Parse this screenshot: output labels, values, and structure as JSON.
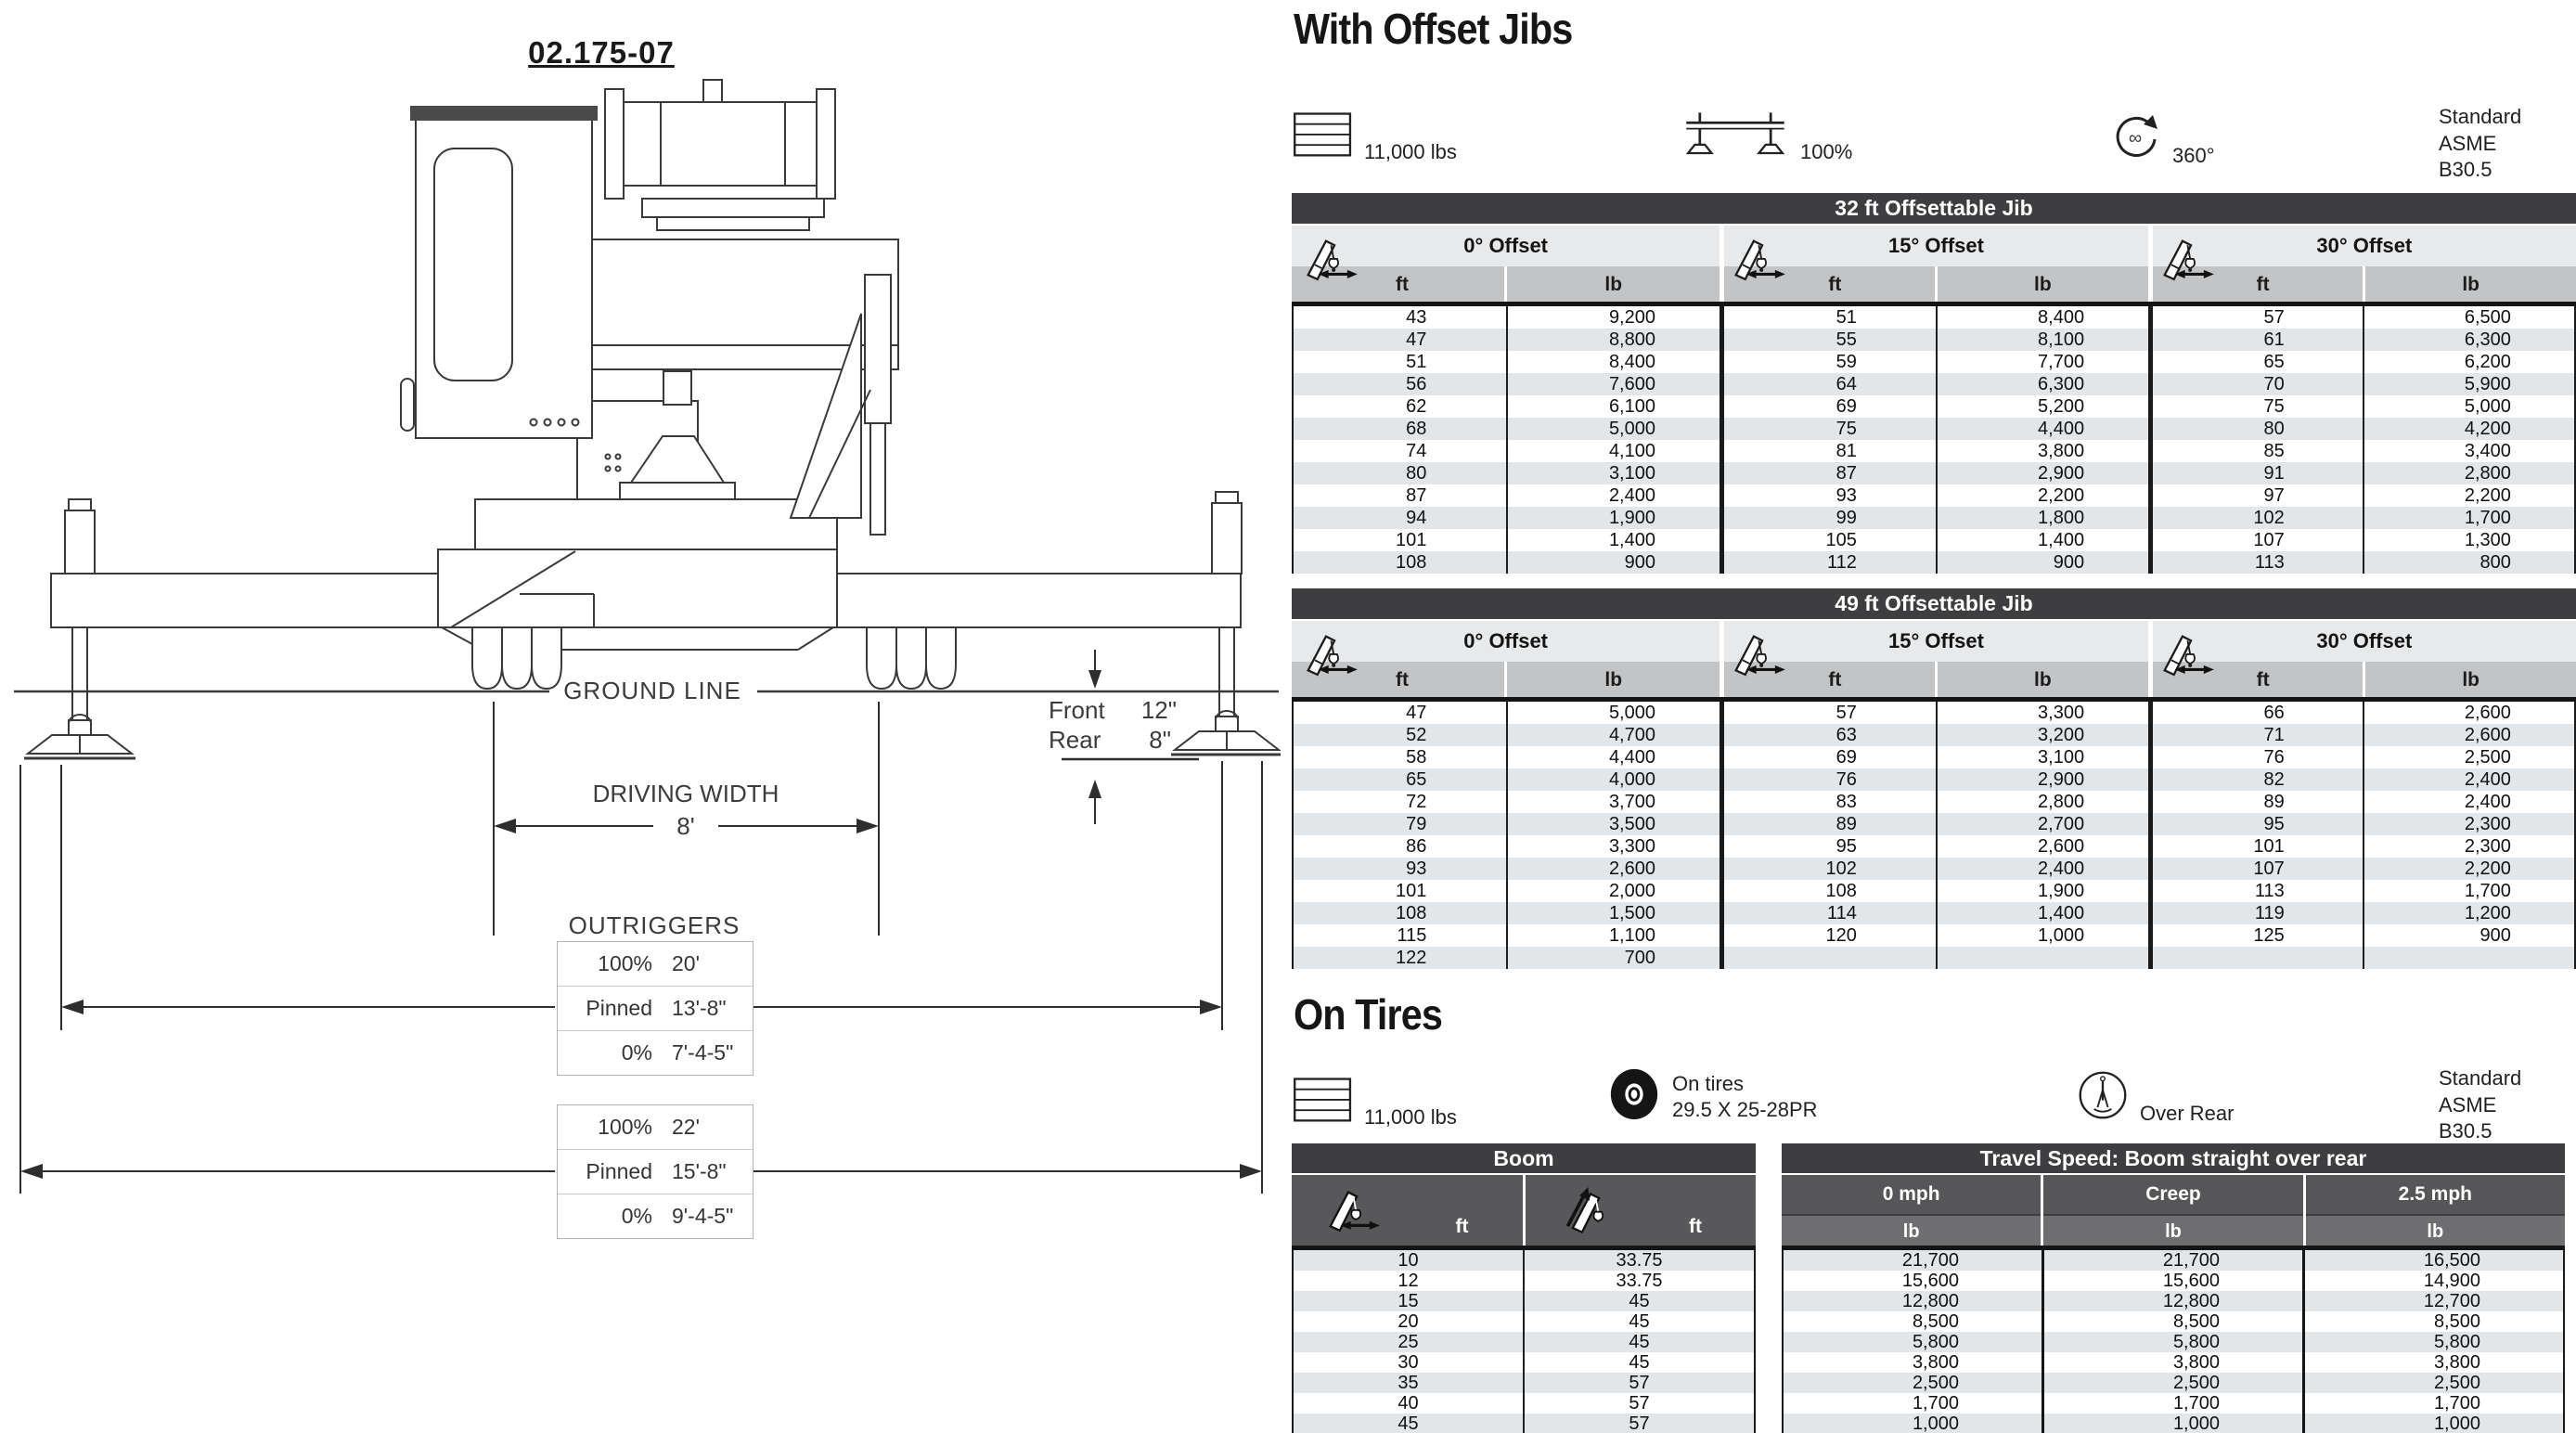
{
  "drawing": {
    "number": "02.175-07",
    "ground_line_label": "GROUND LINE",
    "driving_width_label": "DRIVING WIDTH",
    "driving_width_value": "8'",
    "front_label": "Front",
    "front_value": "12\"",
    "rear_label": "Rear",
    "rear_value": "8\"",
    "outriggers_label": "OUTRIGGERS",
    "outrigger_tables": [
      {
        "rows": [
          {
            "label": "100%",
            "value": "20'"
          },
          {
            "label": "Pinned",
            "value": "13'-8\""
          },
          {
            "label": "0%",
            "value": "7'-4-5\""
          }
        ]
      },
      {
        "rows": [
          {
            "label": "100%",
            "value": "22'"
          },
          {
            "label": "Pinned",
            "value": "15'-8\""
          },
          {
            "label": "0%",
            "value": "9'-4-5\""
          }
        ]
      }
    ]
  },
  "with_offset_jibs": {
    "heading": "With Offset Jibs",
    "badges": [
      {
        "icon": "counterweight-icon",
        "label": "11,000 lbs"
      },
      {
        "icon": "outrigger-100-icon",
        "label": "100%"
      },
      {
        "icon": "swing-360-icon",
        "label": "360°"
      }
    ],
    "standard": [
      "Standard ASME",
      "B30.5"
    ],
    "tables": [
      {
        "title": "32 ft Offsettable Jib",
        "groups": [
          {
            "label": "0° Offset",
            "icon": "jib-offset-icon",
            "ft": "ft",
            "lb": "lb",
            "rows": [
              [
                "43",
                "9,200"
              ],
              [
                "47",
                "8,800"
              ],
              [
                "51",
                "8,400"
              ],
              [
                "56",
                "7,600"
              ],
              [
                "62",
                "6,100"
              ],
              [
                "68",
                "5,000"
              ],
              [
                "74",
                "4,100"
              ],
              [
                "80",
                "3,100"
              ],
              [
                "87",
                "2,400"
              ],
              [
                "94",
                "1,900"
              ],
              [
                "101",
                "1,400"
              ],
              [
                "108",
                "900"
              ]
            ]
          },
          {
            "label": "15° Offset",
            "icon": "jib-offset-icon",
            "ft": "ft",
            "lb": "lb",
            "rows": [
              [
                "51",
                "8,400"
              ],
              [
                "55",
                "8,100"
              ],
              [
                "59",
                "7,700"
              ],
              [
                "64",
                "6,300"
              ],
              [
                "69",
                "5,200"
              ],
              [
                "75",
                "4,400"
              ],
              [
                "81",
                "3,800"
              ],
              [
                "87",
                "2,900"
              ],
              [
                "93",
                "2,200"
              ],
              [
                "99",
                "1,800"
              ],
              [
                "105",
                "1,400"
              ],
              [
                "112",
                "900"
              ]
            ]
          },
          {
            "label": "30° Offset",
            "icon": "jib-offset-icon",
            "ft": "ft",
            "lb": "lb",
            "rows": [
              [
                "57",
                "6,500"
              ],
              [
                "61",
                "6,300"
              ],
              [
                "65",
                "6,200"
              ],
              [
                "70",
                "5,900"
              ],
              [
                "75",
                "5,000"
              ],
              [
                "80",
                "4,200"
              ],
              [
                "85",
                "3,400"
              ],
              [
                "91",
                "2,800"
              ],
              [
                "97",
                "2,200"
              ],
              [
                "102",
                "1,700"
              ],
              [
                "107",
                "1,300"
              ],
              [
                "113",
                "800"
              ]
            ]
          }
        ]
      },
      {
        "title": "49 ft Offsettable Jib",
        "groups": [
          {
            "label": "0° Offset",
            "icon": "jib-offset-icon",
            "ft": "ft",
            "lb": "lb",
            "rows": [
              [
                "47",
                "5,000"
              ],
              [
                "52",
                "4,700"
              ],
              [
                "58",
                "4,400"
              ],
              [
                "65",
                "4,000"
              ],
              [
                "72",
                "3,700"
              ],
              [
                "79",
                "3,500"
              ],
              [
                "86",
                "3,300"
              ],
              [
                "93",
                "2,600"
              ],
              [
                "101",
                "2,000"
              ],
              [
                "108",
                "1,500"
              ],
              [
                "115",
                "1,100"
              ],
              [
                "122",
                "700"
              ]
            ]
          },
          {
            "label": "15° Offset",
            "icon": "jib-offset-icon",
            "ft": "ft",
            "lb": "lb",
            "rows": [
              [
                "57",
                "3,300"
              ],
              [
                "63",
                "3,200"
              ],
              [
                "69",
                "3,100"
              ],
              [
                "76",
                "2,900"
              ],
              [
                "83",
                "2,800"
              ],
              [
                "89",
                "2,700"
              ],
              [
                "95",
                "2,600"
              ],
              [
                "102",
                "2,400"
              ],
              [
                "108",
                "1,900"
              ],
              [
                "114",
                "1,400"
              ],
              [
                "120",
                "1,000"
              ]
            ]
          },
          {
            "label": "30° Offset",
            "icon": "jib-offset-icon",
            "ft": "ft",
            "lb": "lb",
            "rows": [
              [
                "66",
                "2,600"
              ],
              [
                "71",
                "2,600"
              ],
              [
                "76",
                "2,500"
              ],
              [
                "82",
                "2,400"
              ],
              [
                "89",
                "2,400"
              ],
              [
                "95",
                "2,300"
              ],
              [
                "101",
                "2,300"
              ],
              [
                "107",
                "2,200"
              ],
              [
                "113",
                "1,700"
              ],
              [
                "119",
                "1,200"
              ],
              [
                "125",
                "900"
              ]
            ]
          }
        ]
      }
    ]
  },
  "on_tires": {
    "heading": "On Tires",
    "badges": [
      {
        "icon": "counterweight-icon",
        "label": "11,000 lbs"
      },
      {
        "icon": "tire-icon",
        "label": "On tires",
        "label2": "29.5 X 25-28PR"
      },
      {
        "icon": "over-rear-icon",
        "label": "Over Rear"
      }
    ],
    "standard": [
      "Standard ASME",
      "B30.5"
    ],
    "boom_table": {
      "title": "Boom",
      "columns": [
        {
          "icon": "boom-radius-icon",
          "unit": "ft"
        },
        {
          "icon": "boom-length-icon",
          "unit": "ft"
        }
      ],
      "rows": [
        [
          "10",
          "33.75"
        ],
        [
          "12",
          "33.75"
        ],
        [
          "15",
          "45"
        ],
        [
          "20",
          "45"
        ],
        [
          "25",
          "45"
        ],
        [
          "30",
          "45"
        ],
        [
          "35",
          "57"
        ],
        [
          "40",
          "57"
        ],
        [
          "45",
          "57"
        ]
      ]
    },
    "travel_table": {
      "title": "Travel Speed: Boom straight over rear",
      "columns": [
        {
          "label": "0 mph",
          "unit": "lb"
        },
        {
          "label": "Creep",
          "unit": "lb"
        },
        {
          "label": "2.5 mph",
          "unit": "lb"
        }
      ],
      "rows": [
        [
          "21,700",
          "21,700",
          "16,500"
        ],
        [
          "15,600",
          "15,600",
          "14,900"
        ],
        [
          "12,800",
          "12,800",
          "12,700"
        ],
        [
          "8,500",
          "8,500",
          "8,500"
        ],
        [
          "5,800",
          "5,800",
          "5,800"
        ],
        [
          "3,800",
          "3,800",
          "3,800"
        ],
        [
          "2,500",
          "2,500",
          "2,500"
        ],
        [
          "1,700",
          "1,700",
          "1,700"
        ],
        [
          "1,000",
          "1,000",
          "1,000"
        ]
      ]
    }
  },
  "colors": {
    "header_dark": "#3e3e40",
    "band_light": "#e7e9ea",
    "band_gray": "#c2c4c6",
    "stripe": "#e2e6e9",
    "rule_black": "#141414"
  }
}
